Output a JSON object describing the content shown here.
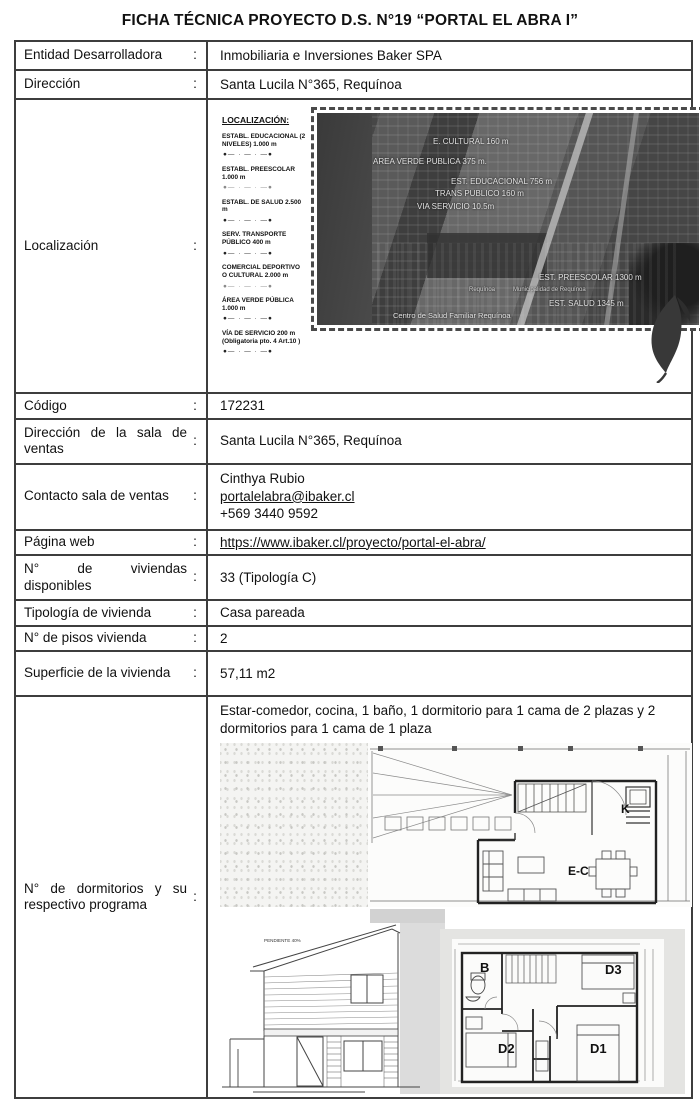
{
  "page": {
    "title": "FICHA TÉCNICA PROYECTO D.S. N°19 “PORTAL EL ABRA I”"
  },
  "colors": {
    "table_border": "#3d3d3d",
    "map_text": "#e2e2e2",
    "leaf": "#383838"
  },
  "rows": {
    "entidad": {
      "label": "Entidad Desarrolladora",
      "colon": ":",
      "value": "Inmobiliaria e Inversiones Baker SPA"
    },
    "direccion": {
      "label": "Dirección",
      "colon": ":",
      "value": "Santa Lucila N°365, Requínoa"
    },
    "localizacion": {
      "label": "Localización",
      "colon": ":"
    },
    "codigo": {
      "label": "Código",
      "colon": ":",
      "value": "172231"
    },
    "direccion_sala": {
      "label": "Dirección de la sala de ventas",
      "colon": ":",
      "value": "Santa Lucila N°365, Requínoa"
    },
    "contacto": {
      "label": "Contacto sala de ventas",
      "colon": ":",
      "name": "Cinthya Rubio",
      "email": "portalelabra@ibaker.cl",
      "phone": "+569 3440 9592"
    },
    "web": {
      "label": "Página web",
      "colon": ":",
      "value": "https://www.ibaker.cl/proyecto/portal-el-abra/"
    },
    "viviendas": {
      "label": "N° de viviendas disponibles",
      "colon": ":",
      "value": "33 (Tipología C)"
    },
    "tipologia": {
      "label": "Tipología de vivienda",
      "colon": ":",
      "value": "Casa pareada"
    },
    "pisos": {
      "label": "N° de pisos vivienda",
      "colon": ":",
      "value": "2"
    },
    "superficie": {
      "label": "Superficie de la vivienda",
      "colon": ":",
      "value": "57,11 m2"
    },
    "dormitorios": {
      "label": "N° de dormitorios y su respectivo programa",
      "colon": ":",
      "value": "Estar-comedor, cocina, 1 baño, 1 dormitorio para 1 cama de 2 plazas y 2 dormitorios para 1 cama de 1 plaza"
    }
  },
  "localizacion_figure": {
    "legend": {
      "title": "LOCALIZACIÓN:",
      "icon": "●— · — · —●",
      "items": [
        "ESTABL. EDUCACIONAL (2 NIVELES) 1.000 m",
        "ESTABL. PREESCOLAR 1.000 m",
        "ESTABL. DE SALUD 2.500 m",
        "SERV. TRANSPORTE PÚBLICO 400 m",
        "COMERCIAL DEPORTIVO O CULTURAL 2.000 m",
        "ÁREA VERDE PÚBLICA 1.000 m",
        "VÍA DE SERVICIO 200 m (Obligatoria pto. 4 Art.10 )"
      ]
    },
    "map_labels": [
      "E. CULTURAL 160 m",
      "AREA VERDE PUBLICA 375 m.",
      "EST. EDUCACIONAL 756 m",
      "TRANS PUBLICO 160 m",
      "VIA SERVICIO 10.5m",
      "EST. PREESCOLAR 1300 m",
      "Requínoa",
      "Municipalidad de Requínoa",
      "EST. SALUD 1345 m",
      "Centro de Salud Familiar Requínoa"
    ]
  },
  "floorplans": {
    "first_floor": {
      "kitchen": "K",
      "living_dining": "E-C"
    },
    "second_floor": {
      "bath": "B",
      "bedroom1": "D1",
      "bedroom2": "D2",
      "bedroom3": "D3"
    },
    "elevation": {
      "roof_slope": "PENDIENTE 40%"
    }
  }
}
